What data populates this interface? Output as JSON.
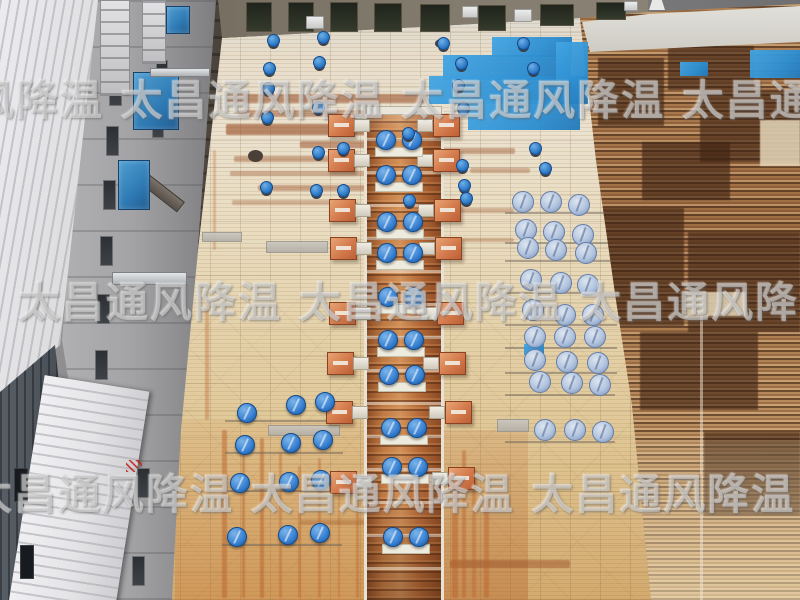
{
  "meta": {
    "width": 800,
    "height": 600,
    "subject": "aerial-drone-photo-factory-roof-ventilation-fans"
  },
  "watermark": {
    "brand": "太昌通风降温",
    "color": "#ffffff",
    "rows": [
      {
        "x": -160,
        "y": 80,
        "text": "太昌通风降温  太昌通风降温  太昌通风降温  太昌通风降温"
      },
      {
        "x": 18,
        "y": 282,
        "text": "太昌通风降温  太昌通风降温  太昌通风降温  太昌通风降温"
      },
      {
        "x": -30,
        "y": 474,
        "text": "太昌通风降温  太昌通风降温  太昌通风降温  太昌通风降温"
      }
    ]
  },
  "colors": {
    "bright_fan_blue": "#2f7cc8",
    "pale_fan_blue": "#b2c4de",
    "blue_paint_patch": "#2d8fd2",
    "orange_unit": "#d37a4c",
    "ridge_rust": "#b56a38",
    "roof_tan": "#e5d2ab",
    "neighbor_rust_dark": "#4a2c1a",
    "machinery_blue": "#2f7ab4"
  },
  "objects": {
    "ridge_fan_pairs": [
      [
        399,
        140
      ],
      [
        399,
        175
      ],
      [
        400,
        222
      ],
      [
        400,
        253
      ],
      [
        401,
        297
      ],
      [
        401,
        340
      ],
      [
        402,
        375
      ],
      [
        404,
        428
      ],
      [
        405,
        467
      ],
      [
        406,
        537
      ]
    ],
    "left_fans": [
      [
        247,
        413
      ],
      [
        296,
        405
      ],
      [
        325,
        402
      ],
      [
        245,
        445
      ],
      [
        291,
        443
      ],
      [
        323,
        440
      ],
      [
        240,
        483
      ],
      [
        289,
        482
      ],
      [
        321,
        480
      ],
      [
        237,
        537
      ],
      [
        288,
        535
      ],
      [
        320,
        533
      ]
    ],
    "right_fans": [
      [
        523,
        202
      ],
      [
        551,
        202
      ],
      [
        579,
        205
      ],
      [
        526,
        230
      ],
      [
        554,
        232
      ],
      [
        583,
        235
      ],
      [
        528,
        248
      ],
      [
        556,
        250
      ],
      [
        586,
        253
      ],
      [
        531,
        280
      ],
      [
        561,
        283
      ],
      [
        588,
        285
      ],
      [
        533,
        310
      ],
      [
        565,
        315
      ],
      [
        593,
        315
      ],
      [
        535,
        337
      ],
      [
        565,
        337
      ],
      [
        595,
        337
      ],
      [
        535,
        360
      ],
      [
        567,
        362
      ],
      [
        598,
        363
      ],
      [
        540,
        382
      ],
      [
        572,
        383
      ],
      [
        600,
        385
      ],
      [
        545,
        430
      ],
      [
        575,
        430
      ],
      [
        603,
        432
      ]
    ],
    "small_fans": [
      [
        273,
        40
      ],
      [
        323,
        37
      ],
      [
        269,
        68
      ],
      [
        319,
        62
      ],
      [
        268,
        88
      ],
      [
        318,
        107
      ],
      [
        267,
        117
      ],
      [
        318,
        152
      ],
      [
        266,
        187
      ],
      [
        316,
        190
      ],
      [
        343,
        148
      ],
      [
        343,
        190
      ],
      [
        408,
        133
      ],
      [
        409,
        200
      ],
      [
        443,
        43
      ],
      [
        461,
        63
      ],
      [
        458,
        85
      ],
      [
        463,
        108
      ],
      [
        523,
        43
      ],
      [
        533,
        68
      ],
      [
        462,
        165
      ],
      [
        464,
        185
      ],
      [
        466,
        198
      ],
      [
        535,
        148
      ],
      [
        545,
        168
      ]
    ],
    "orange_units_left": [
      [
        341,
        125
      ],
      [
        341,
        160
      ],
      [
        342,
        210
      ],
      [
        343,
        248
      ],
      [
        342,
        313
      ],
      [
        340,
        363
      ],
      [
        339,
        412
      ],
      [
        343,
        482
      ]
    ],
    "orange_units_right": [
      [
        446,
        125
      ],
      [
        446,
        160
      ],
      [
        447,
        210
      ],
      [
        448,
        248
      ],
      [
        450,
        313
      ],
      [
        452,
        363
      ],
      [
        458,
        412
      ],
      [
        461,
        478
      ]
    ],
    "blue_patches": [
      [
        492,
        37,
        80,
        20
      ],
      [
        443,
        55,
        128,
        25
      ],
      [
        429,
        76,
        158,
        28
      ],
      [
        468,
        100,
        112,
        30
      ],
      [
        556,
        42,
        32,
        62
      ],
      [
        750,
        50,
        52,
        28
      ],
      [
        680,
        62,
        28,
        14
      ],
      [
        524,
        344,
        20,
        11
      ]
    ],
    "gray_patches": [
      [
        266,
        241,
        62,
        12
      ],
      [
        497,
        419,
        32,
        13
      ],
      [
        268,
        425,
        72,
        11
      ],
      [
        202,
        232,
        40,
        10
      ]
    ],
    "pipes_h": [
      [
        505,
        212,
        112
      ],
      [
        505,
        242,
        112
      ],
      [
        505,
        260,
        112
      ],
      [
        505,
        292,
        112
      ],
      [
        505,
        324,
        112
      ],
      [
        505,
        347,
        112
      ],
      [
        505,
        372,
        112
      ],
      [
        505,
        394,
        110
      ],
      [
        505,
        441,
        110
      ],
      [
        225,
        420,
        118
      ],
      [
        225,
        452,
        118
      ],
      [
        224,
        490,
        118
      ],
      [
        222,
        544,
        120
      ]
    ],
    "rust_streaks_h": [
      [
        226,
        94,
        200,
        9,
        0.55
      ],
      [
        238,
        110,
        185,
        7,
        0.45
      ],
      [
        226,
        124,
        208,
        11,
        0.6
      ],
      [
        300,
        141,
        132,
        7,
        0.5
      ],
      [
        234,
        156,
        192,
        6,
        0.4
      ],
      [
        230,
        171,
        150,
        5,
        0.35
      ],
      [
        258,
        185,
        165,
        6,
        0.4
      ],
      [
        232,
        200,
        120,
        5,
        0.3
      ],
      [
        430,
        148,
        85,
        6,
        0.4
      ],
      [
        470,
        168,
        60,
        5,
        0.35
      ],
      [
        452,
        208,
        62,
        5,
        0.3
      ],
      [
        456,
        238,
        58,
        4,
        0.3
      ],
      [
        450,
        560,
        120,
        8,
        0.45
      ],
      [
        300,
        520,
        90,
        5,
        0.3
      ]
    ],
    "rust_streaks_v": [
      [
        222,
        430,
        5,
        168,
        0.5
      ],
      [
        242,
        446,
        3,
        152,
        0.45
      ],
      [
        260,
        438,
        4,
        160,
        0.5
      ],
      [
        279,
        452,
        3,
        146,
        0.4
      ],
      [
        298,
        466,
        3,
        132,
        0.38
      ],
      [
        318,
        458,
        3,
        140,
        0.4
      ],
      [
        338,
        470,
        2,
        128,
        0.35
      ],
      [
        356,
        480,
        3,
        118,
        0.4
      ],
      [
        452,
        470,
        6,
        128,
        0.5
      ],
      [
        462,
        450,
        4,
        148,
        0.45
      ],
      [
        472,
        478,
        4,
        120,
        0.4
      ],
      [
        484,
        500,
        5,
        98,
        0.45
      ],
      [
        205,
        300,
        4,
        120,
        0.35
      ],
      [
        213,
        150,
        3,
        100,
        0.3
      ]
    ],
    "neighbor_dark_blocks": [
      [
        598,
        58,
        66,
        68
      ],
      [
        668,
        46,
        86,
        44
      ],
      [
        700,
        90,
        100,
        72
      ],
      [
        642,
        142,
        88,
        58
      ],
      [
        598,
        208,
        86,
        118
      ],
      [
        688,
        232,
        112,
        100
      ],
      [
        640,
        332,
        118,
        78
      ],
      [
        704,
        432,
        96,
        84
      ]
    ],
    "neighbor_light_blocks": [
      [
        686,
        292,
        60,
        24
      ],
      [
        760,
        120,
        40,
        46
      ]
    ],
    "facade_windows": [
      [
        246,
        2,
        26,
        30
      ],
      [
        288,
        2,
        26,
        30
      ],
      [
        330,
        2,
        28,
        30
      ],
      [
        374,
        3,
        28,
        29
      ],
      [
        420,
        4,
        30,
        28
      ],
      [
        478,
        5,
        28,
        26
      ],
      [
        540,
        4,
        34,
        22
      ],
      [
        596,
        2,
        30,
        18
      ]
    ],
    "facade_units": [
      [
        306,
        16,
        18,
        13
      ],
      [
        462,
        6,
        16,
        12
      ],
      [
        514,
        9,
        18,
        13
      ],
      [
        624,
        1,
        14,
        10
      ]
    ],
    "wall_windows": [
      [
        112,
        26,
        13,
        30
      ],
      [
        109,
        76,
        13,
        30
      ],
      [
        106,
        126,
        13,
        30
      ],
      [
        103,
        180,
        13,
        30
      ],
      [
        100,
        236,
        13,
        30
      ],
      [
        97,
        294,
        13,
        30
      ],
      [
        95,
        350,
        13,
        30
      ],
      [
        160,
        8,
        12,
        26
      ],
      [
        156,
        60,
        12,
        26
      ],
      [
        152,
        112,
        12,
        26
      ],
      [
        137,
        468,
        13,
        30
      ],
      [
        132,
        556,
        13,
        30
      ]
    ],
    "dark_wall_windows": [
      [
        14,
        468,
        14,
        34
      ],
      [
        20,
        545,
        14,
        34
      ]
    ],
    "alley_machines": [
      [
        133,
        72,
        46,
        58
      ],
      [
        118,
        160,
        32,
        50
      ],
      [
        166,
        6,
        24,
        28
      ]
    ],
    "white_crates": [
      [
        100,
        0,
        30,
        96
      ],
      [
        142,
        0,
        24,
        64
      ]
    ],
    "metal_beams": [
      [
        112,
        272,
        75,
        13
      ],
      [
        150,
        68,
        60,
        9
      ]
    ],
    "misc_dark": [
      [
        248,
        150,
        15,
        12
      ],
      [
        435,
        39,
        12,
        9
      ]
    ]
  }
}
